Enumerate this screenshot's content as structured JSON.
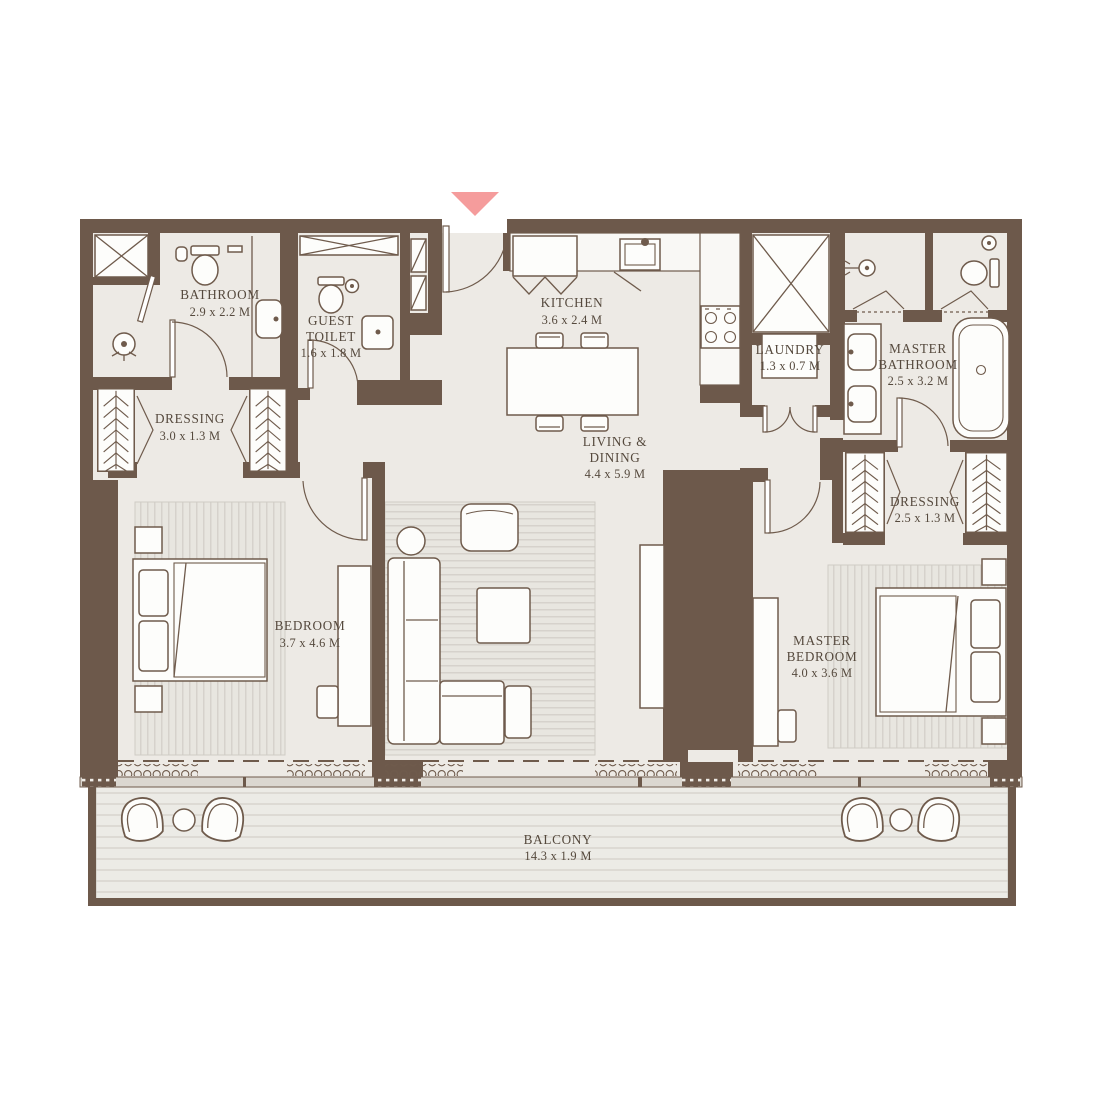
{
  "colors": {
    "wall": "#6d594b",
    "floor": "#edeae5",
    "accent_entrance": "#f59c9c",
    "label_text": "#55493d"
  },
  "icons": {
    "entrance_marker": "triangle-down"
  },
  "rooms": {
    "bathroom": {
      "lines": [
        "BATHROOM"
      ],
      "dims": "2.9 x 2.2 M"
    },
    "guest_toilet": {
      "lines": [
        "GUEST",
        "TOILET"
      ],
      "dims": "1.6 x 1.8 M"
    },
    "dressing_left": {
      "lines": [
        "DRESSING"
      ],
      "dims": "3.0 x 1.3 M"
    },
    "kitchen": {
      "lines": [
        "KITCHEN"
      ],
      "dims": "3.6 x 2.4 M"
    },
    "living_dining": {
      "lines": [
        "LIVING &",
        "DINING"
      ],
      "dims": "4.4 x 5.9 M"
    },
    "laundry": {
      "lines": [
        "LAUNDRY"
      ],
      "dims": "1.3 x 0.7 M"
    },
    "master_bathroom": {
      "lines": [
        "MASTER",
        "BATHROOM"
      ],
      "dims": "2.5 x 3.2 M"
    },
    "dressing_right": {
      "lines": [
        "DRESSING"
      ],
      "dims": "2.5 x 1.3 M"
    },
    "bedroom": {
      "lines": [
        "BEDROOM"
      ],
      "dims": "3.7 x 4.6 M"
    },
    "master_bedroom": {
      "lines": [
        "MASTER",
        "BEDROOM"
      ],
      "dims": "4.0 x 3.6 M"
    },
    "balcony": {
      "lines": [
        "BALCONY"
      ],
      "dims": "14.3 x 1.9 M"
    }
  }
}
